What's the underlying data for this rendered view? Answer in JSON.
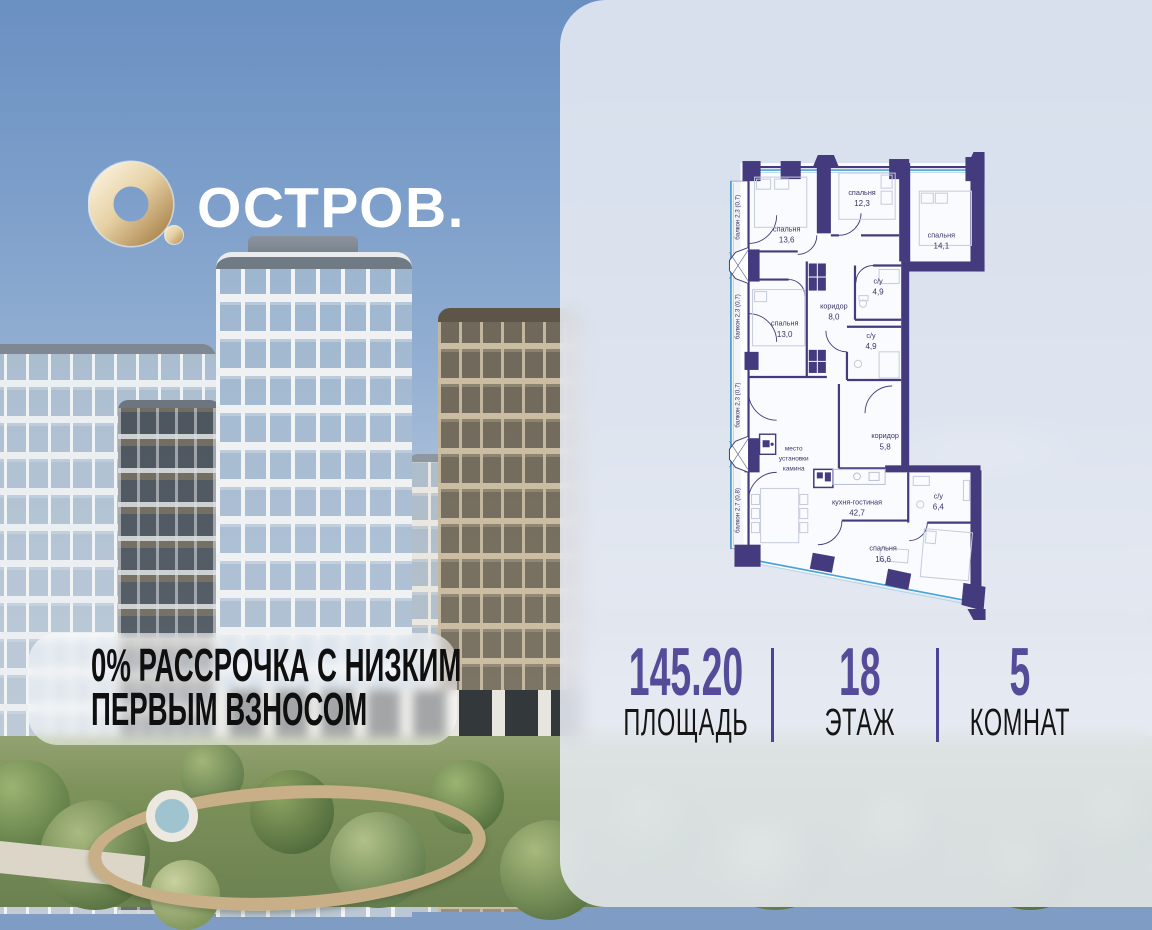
{
  "logo": {
    "brand": "ОСТРОВ."
  },
  "promo": {
    "line1": "0% РАССРОЧКА С НИЗКИМ",
    "line2": "ПЕРВЫМ ВЗНОСОМ"
  },
  "plan": {
    "balconies": [
      {
        "label": "балкон 2,3 (0,7)"
      },
      {
        "label": "балкон 2,3 (0,7)"
      },
      {
        "label": "балкон 2,3 (0,7)"
      },
      {
        "label": "балкон 2,7 (0,8)"
      }
    ],
    "rooms": [
      {
        "name": "спальня",
        "area": "13,6"
      },
      {
        "name": "спальня",
        "area": "12,3"
      },
      {
        "name": "спальня",
        "area": "14,1"
      },
      {
        "name": "с/у",
        "area": "4,9"
      },
      {
        "name": "коридор",
        "area": "8,0"
      },
      {
        "name": "с/у",
        "area": "4,9"
      },
      {
        "name": "спальня",
        "area": "13,0"
      },
      {
        "name": "коридор",
        "area": "5,8"
      },
      {
        "name": "кухня-гостиная",
        "area": "42,7"
      },
      {
        "name": "с/у",
        "area": "6,4"
      },
      {
        "name": "спальня",
        "area": "16,6"
      }
    ],
    "fireplace_note": {
      "l1": "место",
      "l2": "установки",
      "l3": "камина"
    }
  },
  "stats": {
    "items": [
      {
        "value": "145.20",
        "label": "ПЛОЩАДЬ"
      },
      {
        "value": "18",
        "label": "ЭТАЖ"
      },
      {
        "value": "5",
        "label": "КОМНАТ"
      }
    ]
  },
  "colors": {
    "accent": "#554c99",
    "wall": "#443b7e",
    "window": "#4aa3d8",
    "gold": "#d9bd8f"
  }
}
